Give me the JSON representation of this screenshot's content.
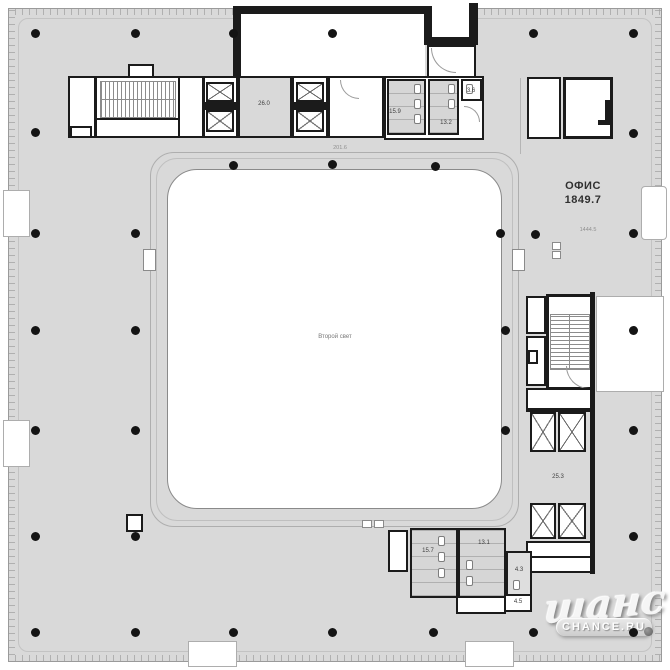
{
  "plan": {
    "office": {
      "name_label": "ОФИС",
      "area_label": "1849.7",
      "sub_area_label": "1444.5"
    },
    "atrium": {
      "label": "Второй свет"
    },
    "dimensions": {
      "corridor": "201.6"
    },
    "rooms": {
      "elevator_lobby_top": "26.0",
      "wc_top_1": "15.9",
      "wc_top_2": "13.2",
      "wc_top_3": "3.6",
      "elevator_lobby_right": "25.3",
      "wc_bottom_1": "15.7",
      "wc_bottom_2": "13.1",
      "wc_bottom_3": "4.3",
      "wc_bottom_4": "4.5"
    },
    "colors": {
      "floor_gray": "#d9d9d9",
      "wall_black": "#1b1b1b",
      "atrium_white": "#ffffff"
    }
  },
  "watermark": {
    "script": "шанс",
    "domain": "CHANCE.RU"
  }
}
